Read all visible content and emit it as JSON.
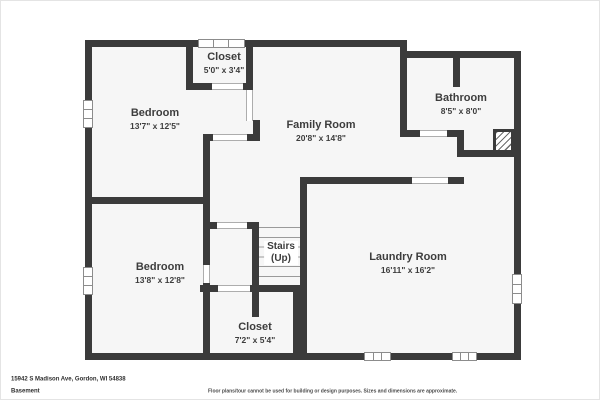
{
  "colors": {
    "wall": "#3b3b3b",
    "floor": "#f6f6f6",
    "background": "#ffffff",
    "text": "#3d3d3d"
  },
  "plan": {
    "level_shown": "Basement",
    "rooms": [
      {
        "name": "Closet",
        "dims": "5'0\" x 3'4\""
      },
      {
        "name": "Bedroom",
        "dims": "13'7\" x 12'5\""
      },
      {
        "name": "Family Room",
        "dims": "20'8\" x 14'8\""
      },
      {
        "name": "Bathroom",
        "dims": "8'5\" x 8'0\""
      },
      {
        "name": "Stairs",
        "dims": "(Up)"
      },
      {
        "name": "Laundry Room",
        "dims": "16'11\" x 16'2\""
      },
      {
        "name": "Bedroom",
        "dims": "13'8\" x 12'8\""
      },
      {
        "name": "Closet",
        "dims": "7'2\" x 5'4\""
      }
    ]
  },
  "footer": {
    "address": "15942 S Madison Ave, Gordon, WI 54838",
    "level": "Basement",
    "disclaimer": "Floor plans/tour cannot be used for building or design purposes. Sizes and dimensions are approximate."
  }
}
